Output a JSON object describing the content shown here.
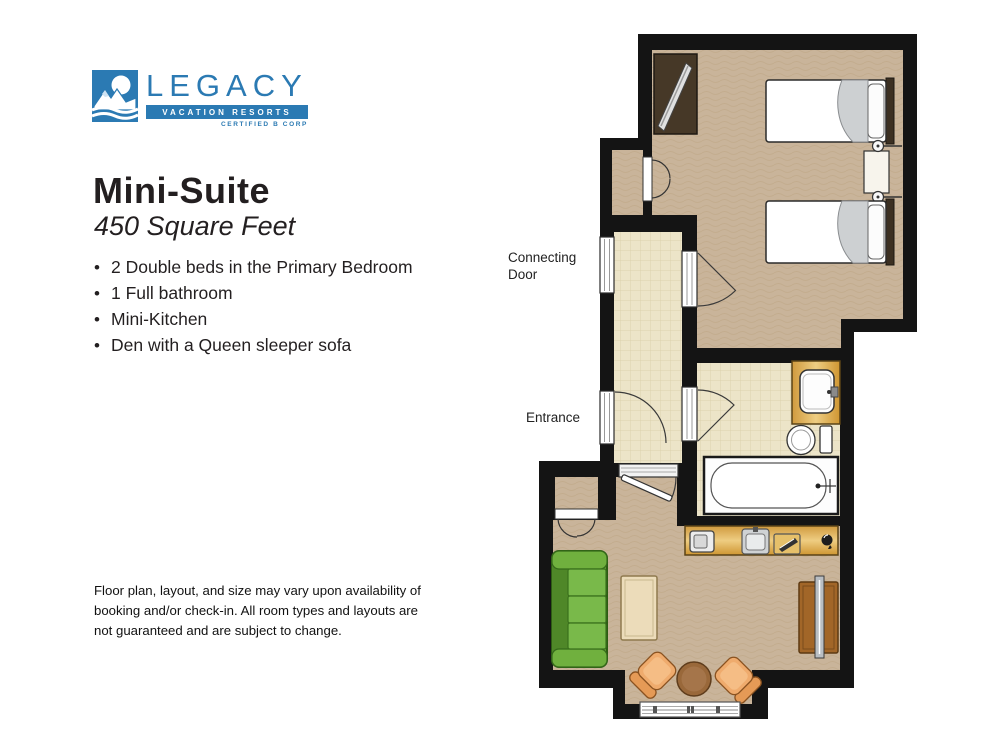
{
  "logo": {
    "brand": "LEGACY",
    "tagline": "VACATION RESORTS",
    "certification": "CERTIFIED B CORP",
    "brand_color": "#2b7ab3"
  },
  "suite": {
    "title": "Mini-Suite",
    "subtitle": "450 Square Feet"
  },
  "features": [
    "2 Double beds in the Primary Bedroom",
    "1 Full bathroom",
    "Mini-Kitchen",
    "Den with a Queen sleeper sofa"
  ],
  "disclaimer": {
    "text": "Floor plan, layout, and size may vary upon availability of booking and/or check-in. All room types and layouts are not guaranteed and are subject to change."
  },
  "floorplan": {
    "labels": {
      "connecting_door": "Connecting Door",
      "entrance": "Entrance"
    },
    "colors": {
      "wall": "#141414",
      "carpet": "#c9b49a",
      "tile": "#ece4c8",
      "wood": "#d39b3f",
      "sofa_green": "#68a839",
      "chair_orange": "#efab6d",
      "bed_white": "#ffffff",
      "blanket_gray": "#cdd0d2"
    }
  }
}
